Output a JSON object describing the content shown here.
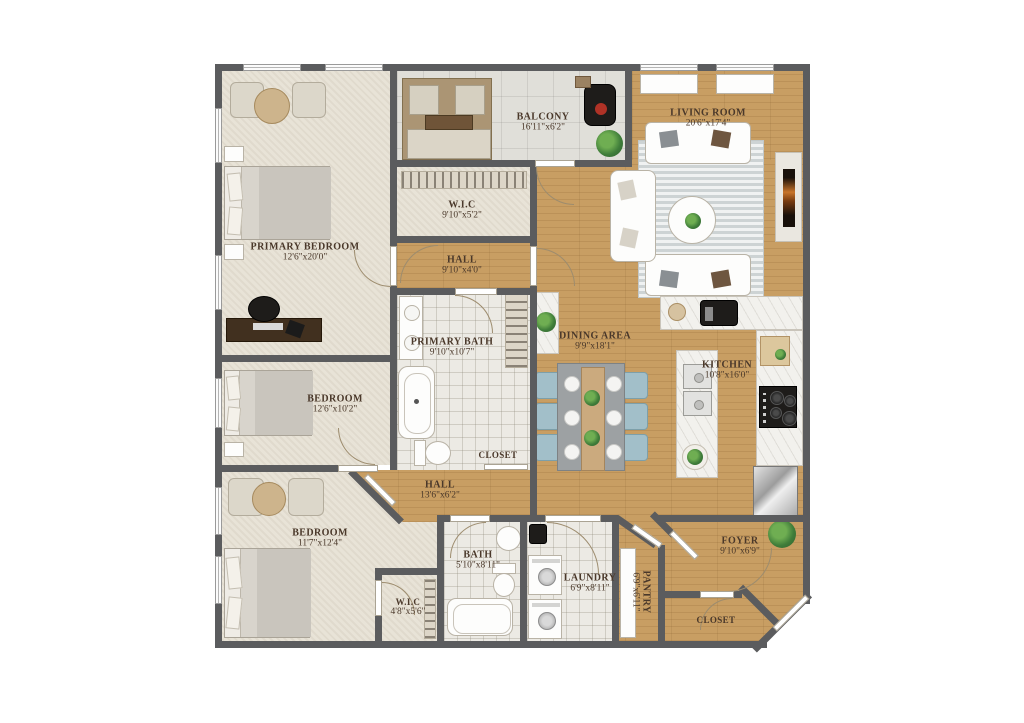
{
  "plan": {
    "type": "apartment-floor-plan",
    "rooms": [
      {
        "id": "primary-bedroom",
        "name": "PRIMARY BEDROOM",
        "dims": "12'6\"x20'0\""
      },
      {
        "id": "balcony",
        "name": "BALCONY",
        "dims": "16'11\"x6'2\""
      },
      {
        "id": "living-room",
        "name": "LIVING ROOM",
        "dims": "20'6\"x17'4\""
      },
      {
        "id": "wic-top",
        "name": "W.I.C",
        "dims": "9'10\"x5'2\""
      },
      {
        "id": "hall-top",
        "name": "HALL",
        "dims": "9'10\"x4'0\""
      },
      {
        "id": "primary-bath",
        "name": "PRIMARY BATH",
        "dims": "9'10\"x10'7\""
      },
      {
        "id": "closet-mid",
        "name": "CLOSET",
        "dims": ""
      },
      {
        "id": "dining-area",
        "name": "DINING AREA",
        "dims": "9'9\"x18'1\""
      },
      {
        "id": "kitchen",
        "name": "KITCHEN",
        "dims": "10'8\"x16'0\""
      },
      {
        "id": "bedroom-mid",
        "name": "BEDROOM",
        "dims": "12'6\"x10'2\""
      },
      {
        "id": "hall-lower",
        "name": "HALL",
        "dims": "13'6\"x6'2\""
      },
      {
        "id": "bedroom-bottom",
        "name": "BEDROOM",
        "dims": "11'7\"x12'4\""
      },
      {
        "id": "wic-bottom",
        "name": "W.I.C",
        "dims": "4'8\"x5'6\""
      },
      {
        "id": "bath",
        "name": "BATH",
        "dims": "5'10\"x8'11\""
      },
      {
        "id": "laundry",
        "name": "LAUNDRY",
        "dims": "6'9\"x8'11\""
      },
      {
        "id": "pantry",
        "name": "PANTRY",
        "dims": "6'9\"x6'11\""
      },
      {
        "id": "foyer",
        "name": "FOYER",
        "dims": "9'10\"x6'9\""
      },
      {
        "id": "closet-br",
        "name": "CLOSET",
        "dims": ""
      }
    ],
    "palette": {
      "wall": "#5b5c5e",
      "wood_floor": "#c89e63",
      "carpet": "#e8e3d7",
      "bath_tile": "#eceae4",
      "balcony_tile": "#e0dfd9",
      "label_text": "#4a382a",
      "dining_chair": "#a2bfc9",
      "plant": "#3f7d3a"
    }
  }
}
